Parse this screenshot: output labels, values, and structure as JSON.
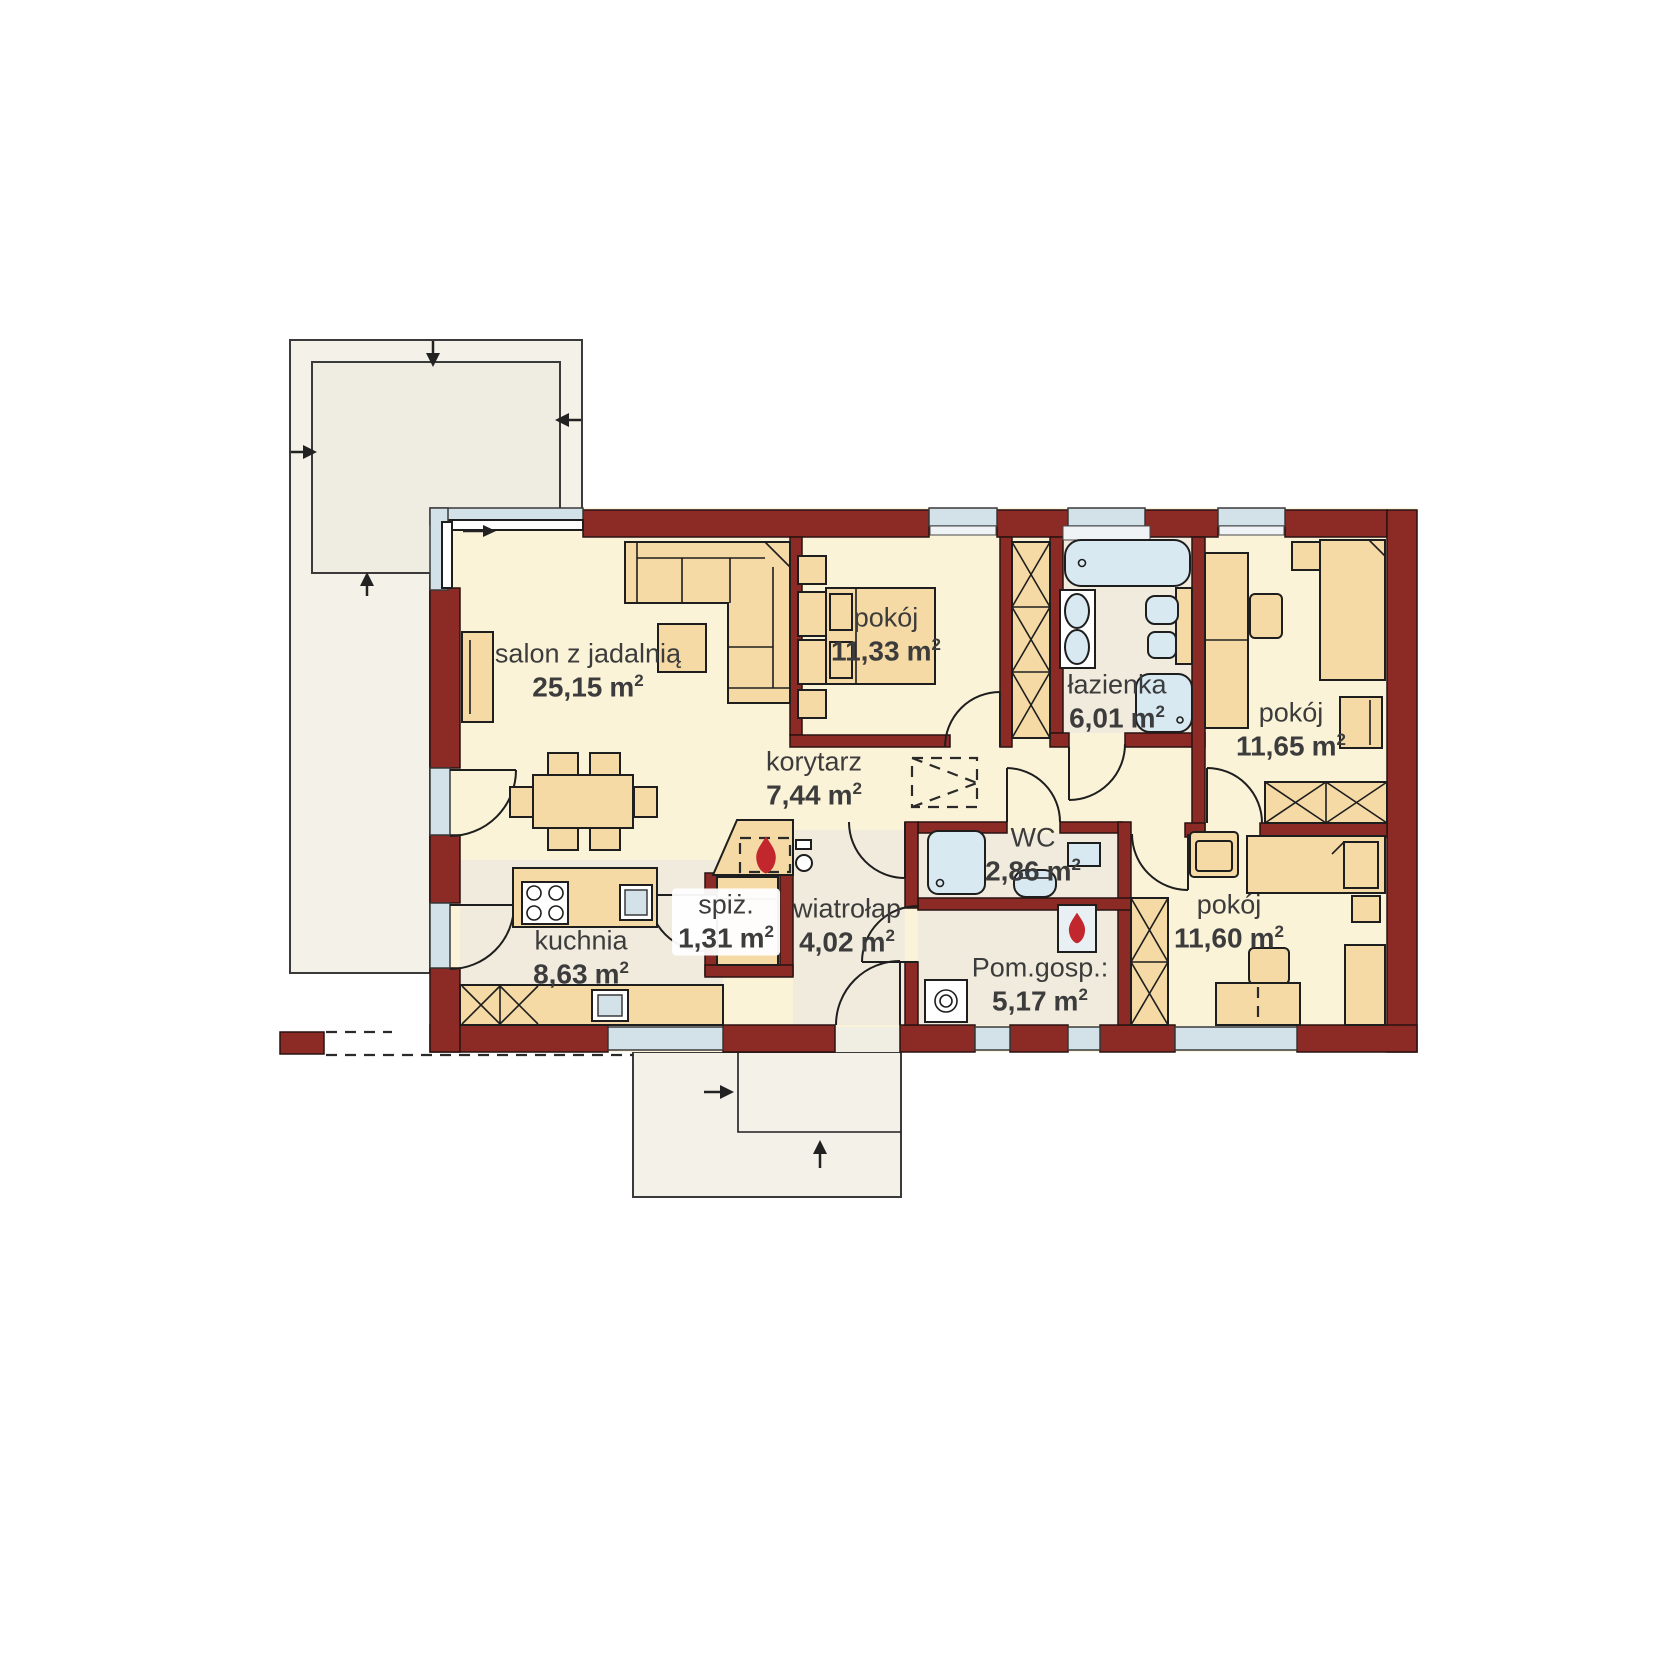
{
  "palette": {
    "wall_color": "#8C2B26",
    "furniture_color": "#F5DAA5",
    "room_floor_color": "#FBF3D8",
    "wet_room_floor_color": "#F1EBDE",
    "terrace_color": "#F3F1E8",
    "window_color": "#D3E2E8",
    "fixture_color": "#D8E9F2",
    "flame_color": "#C1272D",
    "label_color": "#3C3C3C"
  },
  "icons": {
    "fireplace": "flame-icon",
    "utility_heater": "flame-icon",
    "roof_slope_arrows": "arrow-icon",
    "entry_direction_arrows": "arrow-icon",
    "sliding_door_arrow": "arrow-icon"
  },
  "floorplan": {
    "units": {
      "meter": "m",
      "sup": "2"
    },
    "rooms": [
      {
        "key": "salon",
        "name": "salon z jadalnią",
        "area": "25,15"
      },
      {
        "key": "pokoj-1",
        "name": "pokój",
        "area": "11,33"
      },
      {
        "key": "lazienka",
        "name": "łazienka",
        "area": "6,01"
      },
      {
        "key": "pokoj-2",
        "name": "pokój",
        "area": "11,65"
      },
      {
        "key": "korytarz",
        "name": "korytarz",
        "area": "7,44"
      },
      {
        "key": "wc",
        "name": "WC",
        "area": "2,86"
      },
      {
        "key": "wiatrolap",
        "name": "wiatrołap",
        "area": "4,02"
      },
      {
        "key": "spizarnia",
        "name": "spiż.",
        "area": "1,31"
      },
      {
        "key": "kuchnia",
        "name": "kuchnia",
        "area": "8,63"
      },
      {
        "key": "pom-gosp",
        "name": "Pom.gosp.:",
        "area": "5,17"
      },
      {
        "key": "pokoj-3",
        "name": "pokój",
        "area": "11,60"
      }
    ]
  }
}
